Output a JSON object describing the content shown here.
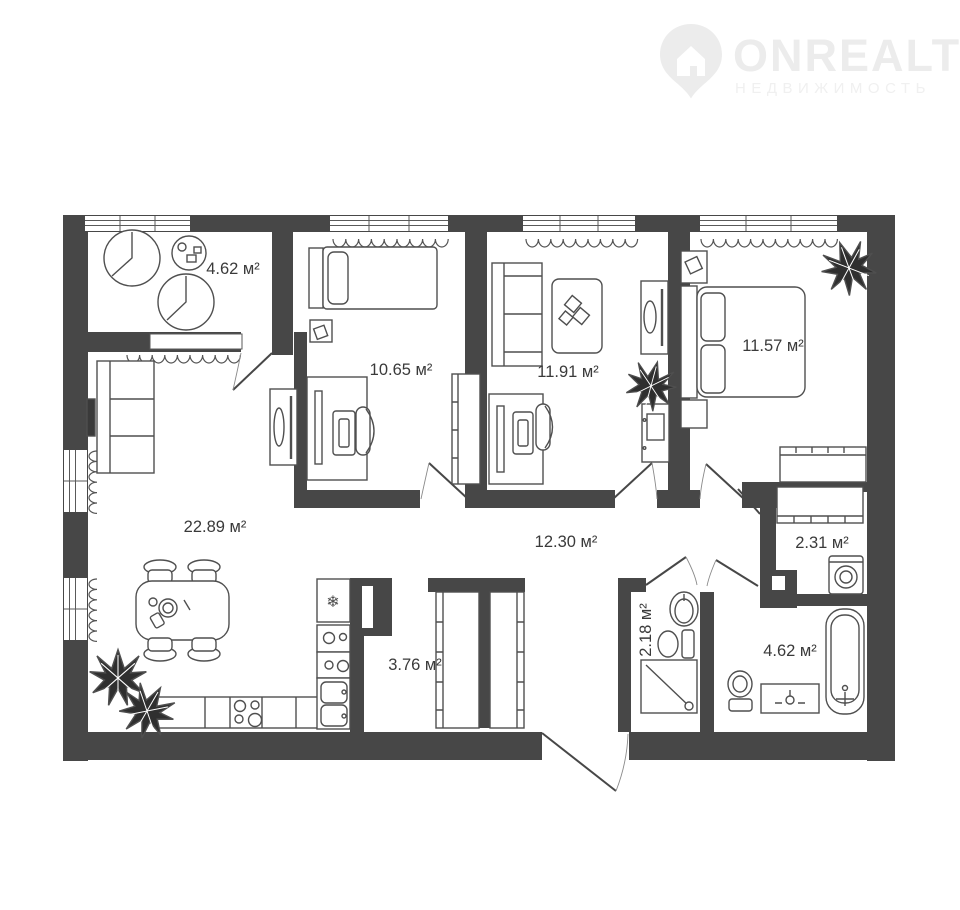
{
  "logo": {
    "brand": "ONREALT",
    "tagline": "НЕДВИЖИМОСТЬ"
  },
  "colors": {
    "wall": "#474747",
    "furniture_line": "#4f4f4f",
    "label_text": "#3a3a3a",
    "logo": "#ececec",
    "background": "#ffffff"
  },
  "icons": {
    "snowflake": "❄"
  },
  "rooms": [
    {
      "name": "loggia",
      "area": "4.62 м²"
    },
    {
      "name": "bedroom-1",
      "area": "10.65 м²"
    },
    {
      "name": "bedroom-2",
      "area": "11.91 м²"
    },
    {
      "name": "bedroom-3",
      "area": "11.57 м²"
    },
    {
      "name": "kitchen-living-room",
      "area": "22.89 м²"
    },
    {
      "name": "hallway",
      "area": "12.30 м²"
    },
    {
      "name": "storage",
      "area": "3.76 м²"
    },
    {
      "name": "wc",
      "area": "2.18 м²"
    },
    {
      "name": "laundry",
      "area": "2.31 м²"
    },
    {
      "name": "bathroom",
      "area": "4.62 м²"
    }
  ]
}
